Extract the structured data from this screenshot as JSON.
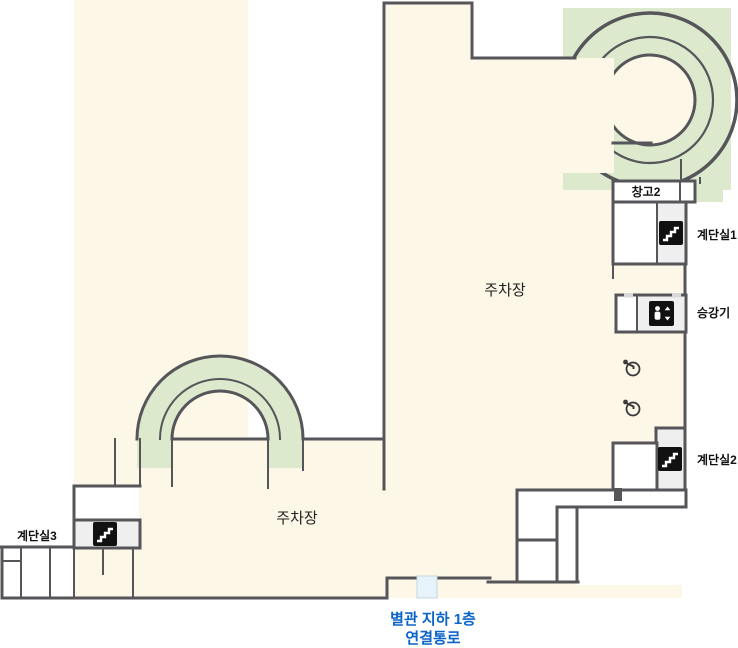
{
  "floorplan": {
    "title": "지하 주차장 평면도",
    "parking_label_upper": "주차장",
    "parking_label_lower": "주차장",
    "rooms": {
      "storage2": {
        "label": "창고2"
      },
      "stairwell1": {
        "label": "계단실1"
      },
      "elevator": {
        "label": "승강기"
      },
      "stairwell2": {
        "label": "계단실2"
      },
      "stairwell3": {
        "label": "계단실3"
      }
    },
    "passage": {
      "line1": "별관 지하 1층",
      "line2": "연결통로"
    },
    "icons": {
      "stairs": "stairs-icon",
      "elevator": "elevator-icon",
      "accessible": "wheelchair-icon"
    },
    "colors": {
      "floor": "#FCF7E7",
      "ramp_green": "#DCE9CC",
      "wall": "#56565A",
      "room_gray": "#EFEFEF",
      "icon_black": "#111111",
      "passage_text_blue": "#0A64C8",
      "passage_fill": "#E6F3FB"
    }
  }
}
